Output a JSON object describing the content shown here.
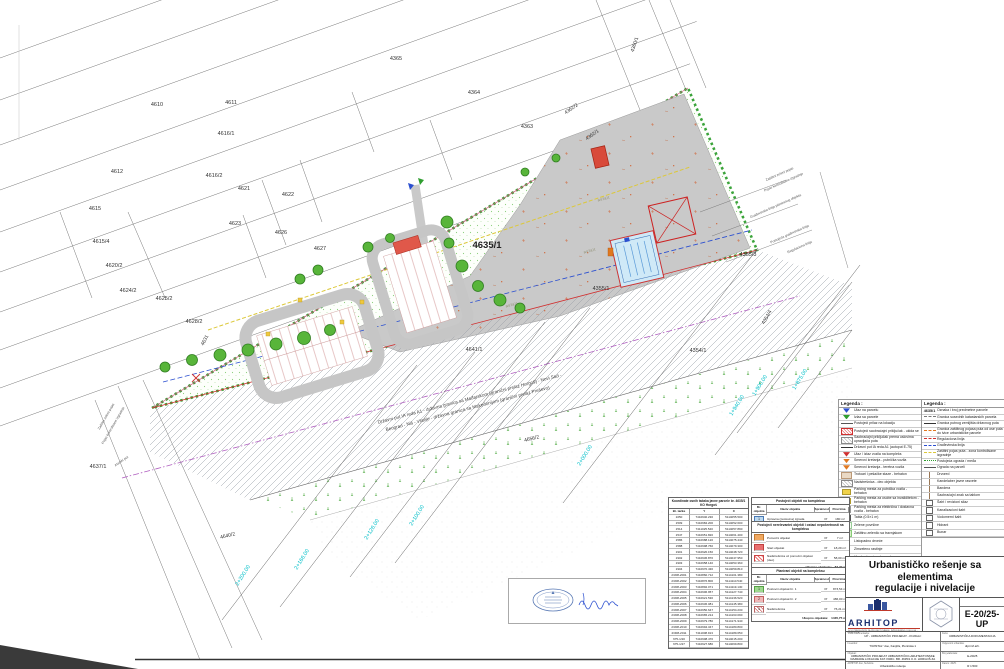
{
  "map": {
    "site_label": "4635/1",
    "parcels": {
      "p4365": "4365",
      "p4364": "4364",
      "p4363": "4363",
      "p4362_2": "4362/2",
      "p4362_1": "4362/1",
      "p4360_1": "4360/1",
      "p4610": "4610",
      "p4611": "4611",
      "p4616_1": "4616/1",
      "p4612": "4612",
      "p4616_2": "4616/2",
      "p4621": "4621",
      "p4622": "4622",
      "p4615": "4615",
      "p4623": "4623",
      "p4626": "4626",
      "p4627": "4627",
      "p4615_4": "4615/4",
      "p4620_2": "4620/2",
      "p4624_2": "4624/2",
      "p4625_2": "4625/2",
      "p4628_2": "4628/2",
      "p4631": "4631",
      "p4637_1": "4637/1",
      "p4640_2": "4640/2",
      "p4641_1": "4641/1",
      "p4355_1": "4355/1",
      "p4355_3": "4355/3",
      "p4354_1": "4354/1",
      "p4354_4": "4354/4",
      "p4656_2": "4656/2"
    },
    "stations": {
      "s1": "2+200.00",
      "s2": "2+166.00",
      "s3": "2+126.00",
      "s4": "2+100.00",
      "s5": "2+000.00",
      "s6": "1+940.00",
      "s7": "1+900.00",
      "s8": "1+875.00"
    },
    "annotations": {
      "road1": "Državni put IA reda A1 - državna granica sa Mađarskom (granični prelaz Horgoš) - Novi Sad -",
      "road2": "Beograd - Niš - Vranje - državna granica sa Makedonijom (granični prelaz Preševo)",
      "asfalt": "asfalt",
      "zastitni": "Zaštitni zeleni pojas",
      "kontrolisane": "Pojas kontrolisane izgradnje",
      "gradjevinska": "Građevinska linija planiranog objekta",
      "postojeca": "Postojeća građevinska linija",
      "regulaciona": "Regulaciona linija",
      "atarski": "Atarski put"
    }
  },
  "legend_left": {
    "title": "Legenda :",
    "items": [
      {
        "sym": "s-blue-tri",
        "label": "Ulaz na parcelu"
      },
      {
        "sym": "s-green-tri",
        "label": "Izlaz sa parcele"
      },
      {
        "sym": "s-line",
        "label": "Postojeći prilaz na lokaciju"
      },
      {
        "sym": "s-redx",
        "label": "Postojeći saobraćajni priključak - ukida se"
      },
      {
        "sym": "s-hatchbox",
        "label": "Saobraćajni priključak prema uslovima upravljača puta"
      },
      {
        "sym": "s-line-dark",
        "label": "Državni put IA reda A1 (autoput E-75)"
      },
      {
        "sym": "s-red-tri",
        "label": "Ulaz / izlaz vozila na kompleks"
      },
      {
        "sym": "s-orange-tri",
        "label": "Smerovi kretanja - putnička vozila"
      },
      {
        "sym": "s-orange-tri",
        "label": "Smerovi kretanja - teretna vozila"
      },
      {
        "sym": "s-beige",
        "label": "Trotoari i pešačke staze - behaton"
      },
      {
        "sym": "s-hatchbox",
        "label": "Nadstrešnica - deo objekta"
      },
      {
        "sym": "s-yellow",
        "label": "Parking mesta za putnička vozila - behaton"
      },
      {
        "sym": "s-yellow",
        "label": "Parking mesta za osobe sa invaliditetom - behaton"
      },
      {
        "sym": "s-gray",
        "label": "Parking mesta za električna i dostavna vozila - behaton"
      },
      {
        "sym": "s-white",
        "label": "Tabla (0.5×1 m)"
      },
      {
        "sym": "s-dots",
        "label": "Zelene površine"
      },
      {
        "sym": "s-lightgreen",
        "label": "Zaštitno zelenilo sa travnjakom"
      },
      {
        "sym": "s-tree",
        "label": "Listopadno drveće"
      },
      {
        "sym": "s-tree",
        "label": "Zimzeleno rastinje"
      },
      {
        "sym": "s-tree-dark",
        "label": "Visoko drveće - drvored"
      },
      {
        "sym": "s-mark",
        "label": "Oznake nivelacionih kota"
      }
    ]
  },
  "legend_right": {
    "title": "Legenda :",
    "parcel_sym": "4635/1",
    "parcel_label": "Oznaka i broj predmetne parcele",
    "items": [
      {
        "sym": "s-line-dash",
        "label": "Granica susednih katastarskih parcela"
      },
      {
        "sym": "s-line-dark",
        "label": "Granica putnog zemljišta državnog puta"
      },
      {
        "sym": "s-line-orange",
        "label": "Granica zaštitnog pojasa puta od ose puta do ivice urbanističke parcele"
      },
      {
        "sym": "s-line-red",
        "label": "Regulaciona linija"
      },
      {
        "sym": "s-line-blue",
        "label": "Građevinska linija"
      },
      {
        "sym": "s-line-yellow",
        "label": "Zaštitni pojas puta - zona kontrolisane izgradnje"
      },
      {
        "sym": "s-line-greendots",
        "label": "Postojeća ograda / međa"
      },
      {
        "sym": "s-line",
        "label": "Ograda na parceli"
      },
      {
        "sym": "s-pole",
        "label": "Drvored"
      },
      {
        "sym": "s-pole",
        "label": "Kandelaber javne rasvete"
      },
      {
        "sym": "s-pole",
        "label": "Bandera"
      },
      {
        "sym": "s-pole",
        "label": "Saobraćajni znak sa tablom"
      },
      {
        "sym": "s-boxw",
        "label": "Šaht / revizioni silaz"
      },
      {
        "sym": "s-boxw",
        "label": "Kanalizacioni šaht"
      },
      {
        "sym": "s-boxw",
        "label": "Vodomerni šaht"
      },
      {
        "sym": "s-boxw",
        "label": "Hidrant"
      },
      {
        "sym": "s-boxw",
        "label": "Bunar"
      }
    ]
  },
  "coord_table": {
    "title": "Koordinate osnih tačaka javne parcele br. 4635/1 KO Horgoš",
    "headers": [
      "Br. tačke",
      "Y",
      "X"
    ],
    "rows": [
      {
        "n": "1050",
        "y": "7410940.230",
        "x": "5114055.500"
      },
      {
        "n": "1509",
        "y": "7410984.200",
        "x": "5114052.600"
      },
      {
        "n": "1514",
        "y": "7411025.540",
        "x": "5114057.890"
      },
      {
        "n": "1547",
        "y": "7410951.820",
        "x": "5114061.400"
      },
      {
        "n": "1586",
        "y": "7410988.120",
        "x": "5114075.440"
      },
      {
        "n": "1588",
        "y": "7410998.760",
        "x": "5114079.300"
      },
      {
        "n": "1901",
        "y": "7410920.150",
        "x": "5114048.720"
      },
      {
        "n": "1902",
        "y": "7410936.870",
        "x": "5114047.950"
      },
      {
        "n": "1903",
        "y": "7410958.140",
        "x": "5114053.360"
      },
      {
        "n": "1904",
        "y": "7410970.430",
        "x": "5114059.810"
      },
      {
        "n": "2/308-2001",
        "y": "7410860.712",
        "x": "5114101.380"
      },
      {
        "n": "2/308-2002",
        "y": "7410876.800",
        "x": "5114110.540"
      },
      {
        "n": "2/308-2003",
        "y": "7410892.071",
        "x": "5114119.130"
      },
      {
        "n": "2/308-2004",
        "y": "7410906.957",
        "x": "5114127.740"
      },
      {
        "n": "2/308-2005",
        "y": "7410921.530",
        "x": "5114136.520"
      },
      {
        "n": "2/308-2006",
        "y": "7410936.081",
        "x": "5114145.380"
      },
      {
        "n": "2/308-2007",
        "y": "7410950.647",
        "x": "5114154.230"
      },
      {
        "n": "2/308-2008",
        "y": "7410965.214",
        "x": "5114163.090"
      },
      {
        "n": "2/308-2009",
        "y": "7410979.780",
        "x": "5114171.940"
      },
      {
        "n": "2/308-2010",
        "y": "7410994.347",
        "x": "5114180.800"
      },
      {
        "n": "2/308-2011",
        "y": "7411008.913",
        "x": "5114189.650"
      },
      {
        "n": "675-1/20",
        "y": "7410908.470",
        "x": "5114015.200"
      },
      {
        "n": "675-1/27",
        "y": "7410927.680",
        "x": "5114069.800"
      }
    ]
  },
  "existing_table": {
    "title": "Postojeći objekti na kompleksu",
    "headers": [
      "Br. objekta",
      "Naziv objekta",
      "Spratnost",
      "Površina"
    ],
    "rows": [
      {
        "sym": "s-blue",
        "n": "1",
        "name": "Upravna (poslovna) zgrada",
        "spr": "Pr",
        "area": "180 m²"
      }
    ]
  },
  "removed_table": {
    "title": "Postojeći nerelevantni objekti i ostaci nepokretnosti na kompleksu",
    "rows": [
      {
        "sym": "s-orange",
        "n": "",
        "name": "Pomoćni objekat",
        "spr": "Pr",
        "area": "7 m²"
      },
      {
        "sym": "s-red",
        "n": "",
        "name": "Stari objekat",
        "spr": "Pr",
        "area": "18,29 m²"
      },
      {
        "sym": "s-redhatch",
        "n": "",
        "name": "Nadstrešnica uz pomoćni objekat (deo)",
        "spr": "Pr",
        "area": "58,00 m²"
      }
    ],
    "total_label": "Ukupno objekata:",
    "total": "83,29 m²"
  },
  "planned_table": {
    "title": "Planirani objekti na kompleksu",
    "headers": [
      "Br. objekta",
      "Naziv objekta",
      "Spratnost",
      "Površina"
    ],
    "rows": [
      {
        "sym": "s-green",
        "n": "1",
        "name": "Poslovni objekat br. 1",
        "spr": "Pr",
        "area": "873,54 m²"
      },
      {
        "sym": "s-pink",
        "n": "2",
        "name": "Poslovni objekat br. 2",
        "spr": "Pr",
        "area": "486,00 m²"
      },
      {
        "sym": "s-hatch",
        "n": "3",
        "name": "Nadstrešnica",
        "spr": "Pr",
        "area": "76,21 m²"
      }
    ],
    "total_label": "Ukupno objekata:",
    "total": "1435,75 m²"
  },
  "title_block": {
    "title1": "Urbanističko rešenje sa elementima",
    "title2": "regulacije i nivelacije",
    "firm_name": "ARHITOP",
    "firm_sub": "DOO PREDUZEĆE ZA PROJEKTOVANJE, INŽENJERING I USLUGE - SUBOTICA",
    "number": "E-20/25-UP",
    "rows": [
      {
        "l": "Vrsta dokumentacije:",
        "v": "UP - URBANISTIČKI PROJEKAT - KNJIGA I",
        "l2": "Faza:",
        "v2": "URBANISTIČKA DOKUMENTACIJA"
      },
      {
        "l": "Investitor:",
        "v": "\"KRISTAL\" doo, Kanjiža, Pionirska 1",
        "l2": "Odgovorni urbanista:",
        "v2": "dipl.inž.arh."
      },
      {
        "l": "Objekat:",
        "v": "URBANISTIČKI PROJEKAT URBANISTIČKO-ARHITEKTONSKE RAZRADE LOKACIJE KAT. PARC. BR. 4635/1 K.O. HORGOŠ ZA IZGRADNJU POSLOVNOG KOMPLEKSA",
        "l2": "Broj elaborata:",
        "v2": "E-20/25"
      },
      {
        "l": "ARHITOP doo, Subotica",
        "v": "Urbanističko rešenje",
        "l2": "Datum: 2025.",
        "v2": "R 1:500"
      }
    ]
  }
}
